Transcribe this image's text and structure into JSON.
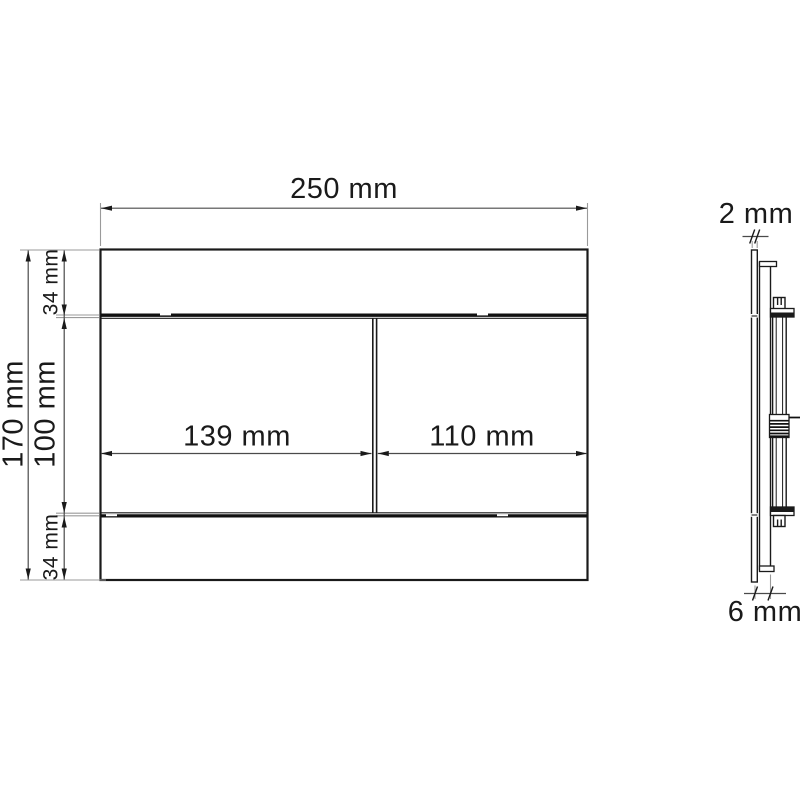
{
  "views": {
    "front": {
      "dimensions": {
        "width": "250 mm",
        "height": "170 mm",
        "top_strip": "34 mm",
        "center_section": "100 mm",
        "bottom_strip": "34 mm",
        "left_button": "139 mm",
        "right_button": "110 mm"
      }
    },
    "side": {
      "dimensions": {
        "plate_thickness": "2 mm",
        "mounting_depth": "6 mm"
      }
    }
  },
  "colors": {
    "outline": "#1a1a1a",
    "dimension_line": "#4a4a4a",
    "extension_line": "#9a9a9a",
    "background": "#ffffff"
  }
}
